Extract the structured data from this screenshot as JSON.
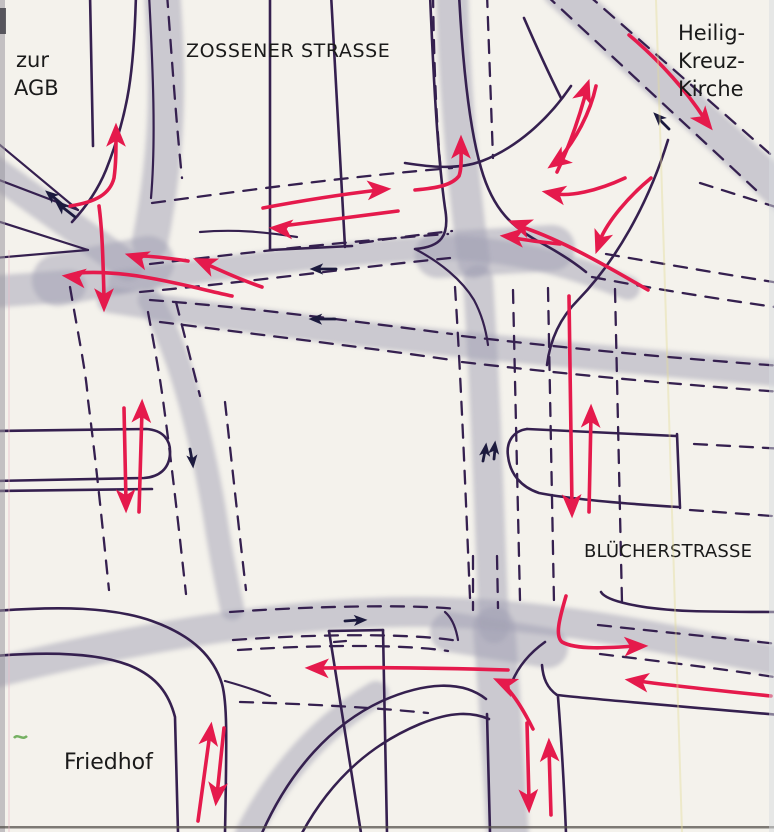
{
  "labels": {
    "zur_agb_line1": "zur",
    "zur_agb_line2": "AGB",
    "zossener_strasse": "ZOSSENER STRASSE",
    "heilig_line1": "Heilig-",
    "heilig_line2": "Kreuz-",
    "heilig_line3": "Kirche",
    "bluecherstrasse": "BLÜCHERSTRASSE",
    "friedhof": "Friedhof"
  },
  "colors": {
    "paper": "#f4f2ec",
    "ink": "#35204f",
    "pencil": "#a2a0b4",
    "red": "#e51a4c",
    "black_arrow": "#1c1a3e",
    "label_text": "#1a1a1a",
    "green_mark": "#55a040"
  },
  "arrows": {
    "red": [
      {
        "dir": "north",
        "d": "M70,206 C96,202 110,194 114,178 C116,164 116,150 116,134",
        "x": 116,
        "y": 127,
        "a": -90
      },
      {
        "dir": "east",
        "d": "M263,208 C300,201 345,194 379,190",
        "x": 387,
        "y": 189,
        "a": -4
      },
      {
        "dir": "west",
        "d": "M398,211 C360,216 320,221 282,226",
        "x": 273,
        "y": 228,
        "a": 184
      },
      {
        "dir": "west",
        "d": "M232,296 C190,287 130,269 78,273",
        "x": 66,
        "y": 276,
        "a": 187
      },
      {
        "dir": "south",
        "d": "M99,206 C102,228 103,256 104,298",
        "x": 104,
        "y": 308,
        "a": 90
      },
      {
        "dir": "northwest",
        "d": "M262,287 C238,279 220,270 206,264",
        "x": 197,
        "y": 260,
        "a": 203
      },
      {
        "dir": "northwest",
        "d": "M188,261 C168,258 152,256 140,256",
        "x": 129,
        "y": 255,
        "a": 197
      },
      {
        "dir": "north",
        "d": "M415,190 C438,188 452,185 459,176 C462,168 461,155 461,148",
        "x": 461,
        "y": 139,
        "a": -90
      },
      {
        "dir": "southwest",
        "d": "M596,86 C590,114 575,140 560,158",
        "x": 551,
        "y": 166,
        "a": 145
      },
      {
        "dir": "northeast",
        "d": "M557,172 C568,149 578,121 585,96",
        "x": 588,
        "y": 83,
        "a": -71
      },
      {
        "dir": "southeast",
        "d": "M629,35 C661,62 688,93 704,118",
        "x": 710,
        "y": 127,
        "a": 51
      },
      {
        "dir": "west",
        "d": "M625,178 C595,192 570,196 556,194",
        "x": 546,
        "y": 192,
        "a": 190
      },
      {
        "dir": "west",
        "d": "M648,290 C600,262 560,240 525,228",
        "x": 512,
        "y": 222,
        "a": 200
      },
      {
        "dir": "west",
        "d": "M560,244 C540,242 525,240 514,238",
        "x": 504,
        "y": 236,
        "a": 185
      },
      {
        "dir": "south",
        "d": "M651,178 C628,197 608,221 600,240",
        "x": 597,
        "y": 250,
        "a": 110
      },
      {
        "dir": "north",
        "d": "M139,512 L142,410",
        "x": 142,
        "y": 403,
        "a": -88
      },
      {
        "dir": "south",
        "d": "M124,408 L126,502",
        "x": 126,
        "y": 509,
        "a": 89
      },
      {
        "dir": "south",
        "d": "M569,296 L572,507",
        "x": 572,
        "y": 514,
        "a": 89
      },
      {
        "dir": "north",
        "d": "M589,512 L591,415",
        "x": 591,
        "y": 408,
        "a": -89
      },
      {
        "dir": "east",
        "d": "M566,596 C559,620 555,636 562,642 C576,650 608,648 636,646",
        "x": 644,
        "y": 646,
        "a": -2
      },
      {
        "dir": "west",
        "d": "M771,696 C722,691 674,686 638,681",
        "x": 629,
        "y": 680,
        "a": 188
      },
      {
        "dir": "west",
        "d": "M533,729 C523,709 513,694 505,686",
        "x": 497,
        "y": 680,
        "a": 204
      },
      {
        "dir": "west",
        "d": "M508,670 C440,668 384,667 319,668",
        "x": 309,
        "y": 668,
        "a": 181
      },
      {
        "dir": "south",
        "d": "M527,723 L529,801",
        "x": 529,
        "y": 809,
        "a": 88
      },
      {
        "dir": "north",
        "d": "M551,815 L549,748",
        "x": 549,
        "y": 742,
        "a": -92
      },
      {
        "dir": "north",
        "d": "M198,821 L210,733",
        "x": 211,
        "y": 726,
        "a": -82
      },
      {
        "dir": "south",
        "d": "M224,728 L217,795",
        "x": 216,
        "y": 802,
        "a": 96
      }
    ],
    "ink": [
      {
        "dir": "northwest",
        "d": "M64,206 L51,195",
        "x": 47,
        "y": 192,
        "a": 220
      },
      {
        "dir": "northwest",
        "d": "M75,217 L61,206",
        "x": 57,
        "y": 203,
        "a": 220
      },
      {
        "dir": "west",
        "d": "M336,269 L318,269",
        "x": 312,
        "y": 269,
        "a": 180
      },
      {
        "dir": "west",
        "d": "M335,319 L317,319",
        "x": 311,
        "y": 319,
        "a": 181
      },
      {
        "dir": "northwest",
        "d": "M669,129 L659,119",
        "x": 655,
        "y": 114,
        "a": 225
      },
      {
        "dir": "south",
        "d": "M190,449 L192,460",
        "x": 193,
        "y": 466,
        "a": 84
      },
      {
        "dir": "north",
        "d": "M483,461 L485,451",
        "x": 486,
        "y": 445,
        "a": -83
      },
      {
        "dir": "north",
        "d": "M494,459 L495,449",
        "x": 495,
        "y": 443,
        "a": -83
      },
      {
        "dir": "east",
        "d": "M345,621 L359,620",
        "x": 365,
        "y": 620,
        "a": -2
      }
    ]
  }
}
